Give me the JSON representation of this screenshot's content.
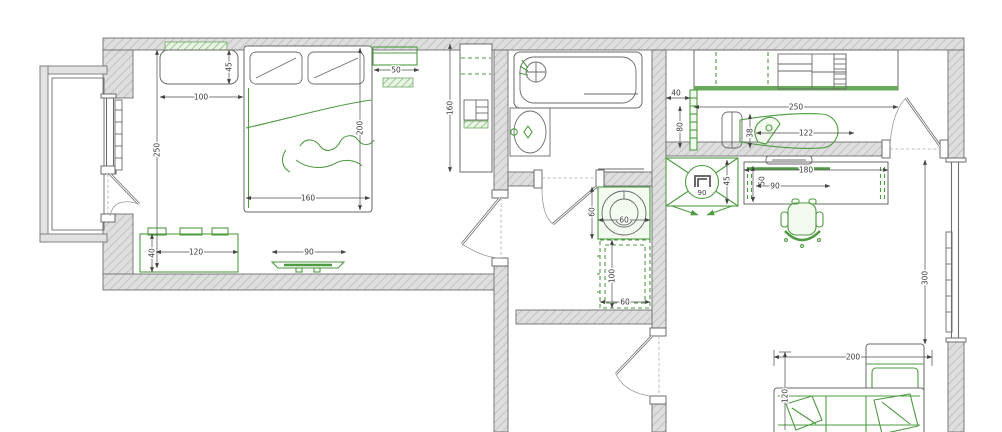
{
  "plan_type": "apartment-floor-plan",
  "colors": {
    "furniture": "#4e9b41",
    "walls": "#dcdcdc",
    "outline": "#5a5a5a",
    "dimension": "#3a3a3a"
  },
  "dims": {
    "bedroom": {
      "bench_width": "100",
      "bench_depth": "45",
      "room_length": "250",
      "bed_length": "200",
      "bed_width": "160",
      "nightstand_width": "50",
      "wardrobe_height": "160",
      "dresser_width": "120",
      "dresser_depth": "40",
      "tv_width": "90"
    },
    "hallway": {
      "washer_depth": "60",
      "washer_width": "60",
      "cabinet_length": "100",
      "cabinet_width": "60"
    },
    "dressing_room": {
      "rack_depth": "40",
      "rack_length": "80",
      "wardrobe_width": "250",
      "ironing_board_length": "122",
      "ironing_board_width": "38"
    },
    "living_room": {
      "corner_unit_depth": "45",
      "corner_unit_label": "90",
      "desk_width": "180",
      "desk_depth": "50",
      "desk_clearance": "90",
      "window_width": "300",
      "sofa_width": "200",
      "sofa_depth": "120"
    }
  }
}
